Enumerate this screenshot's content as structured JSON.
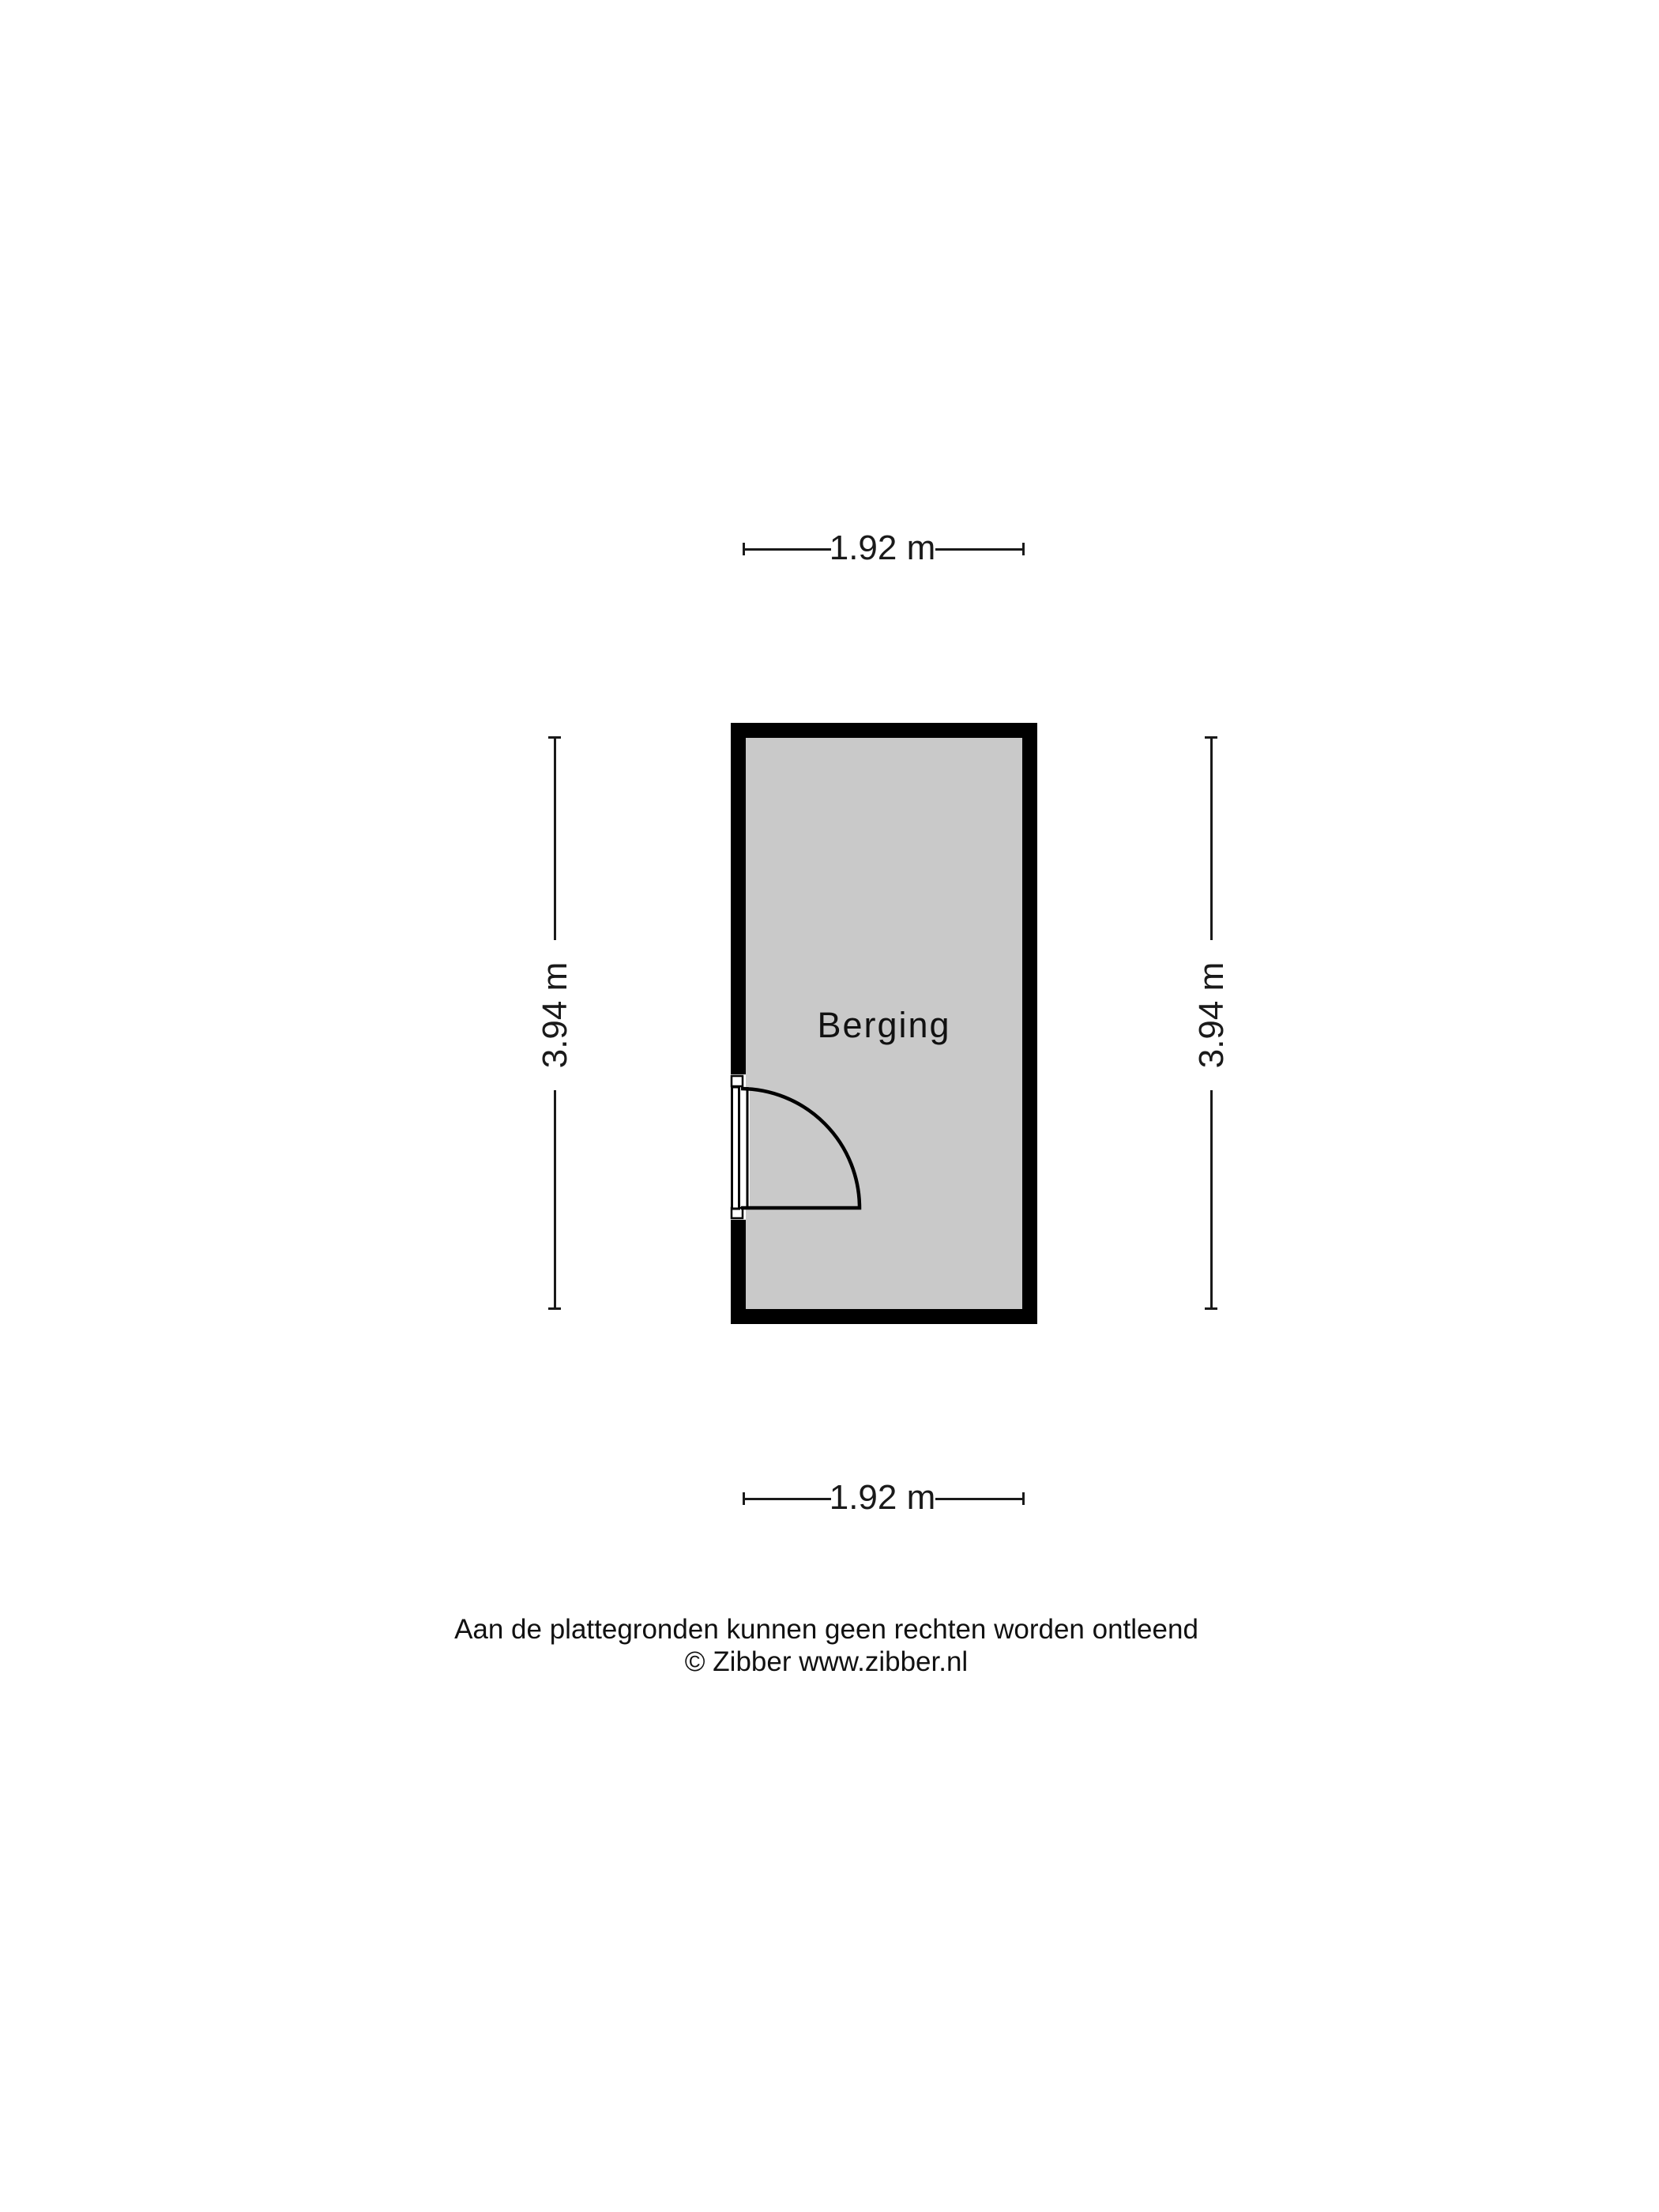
{
  "floorplan": {
    "room": {
      "label": "Berging",
      "floor_fill": "#c9c9c9",
      "wall_color": "#000000"
    },
    "dimensions": {
      "top": "1.92 m",
      "bottom": "1.92 m",
      "left": "3.94 m",
      "right": "3.94 m"
    },
    "footer": {
      "disclaimer": "Aan de plattegronden kunnen geen rechten worden ontleend",
      "copyright": "© Zibber www.zibber.nl"
    }
  }
}
